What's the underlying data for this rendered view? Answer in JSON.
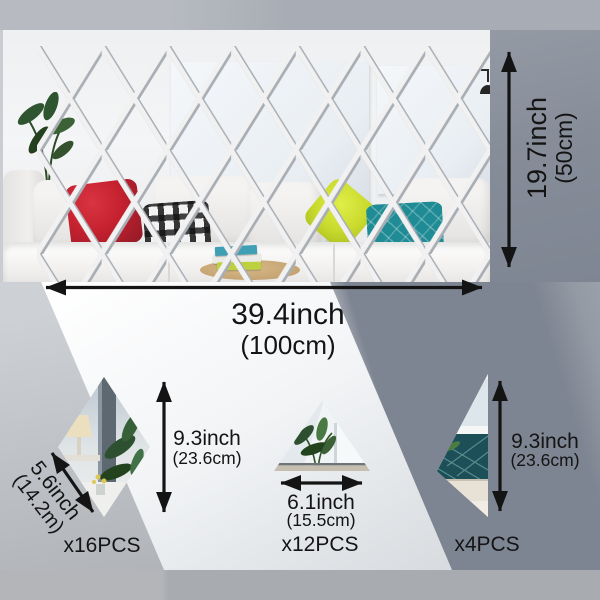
{
  "colors": {
    "label_text": "#141414",
    "arrow": "#141414",
    "bg_top_strip": "#aeb2b8",
    "bg_right_panel": "#868d99",
    "bg_dark_band": "#7e8592",
    "bg_light_band": "#f2f4f6",
    "bottom_strip": "#a8abaf",
    "mirror_grout": "#f1f1f1",
    "pillow_red": "#c5212f",
    "pillow_yellow": "#c9da2e",
    "pillow_teal": "#1f8b94",
    "plant_green": "#2f5430",
    "tray_wood": "#c4a472"
  },
  "main_mirror": {
    "width_label": "39.4inch",
    "width_sub": "(100cm)",
    "height_label": "19.7inch",
    "height_sub": "(50cm)"
  },
  "pieces": {
    "rhombus": {
      "height_label": "9.3inch",
      "height_sub": "(23.6cm)",
      "side_label": "5.6inch",
      "side_sub": "(14.2m)",
      "count": "x16PCS"
    },
    "triangle": {
      "width_label": "6.1inch",
      "width_sub": "(15.5cm)",
      "count": "x12PCS"
    },
    "half_diamond": {
      "height_label": "9.3inch",
      "height_sub": "(23.6cm)",
      "count": "x4PCS"
    }
  }
}
